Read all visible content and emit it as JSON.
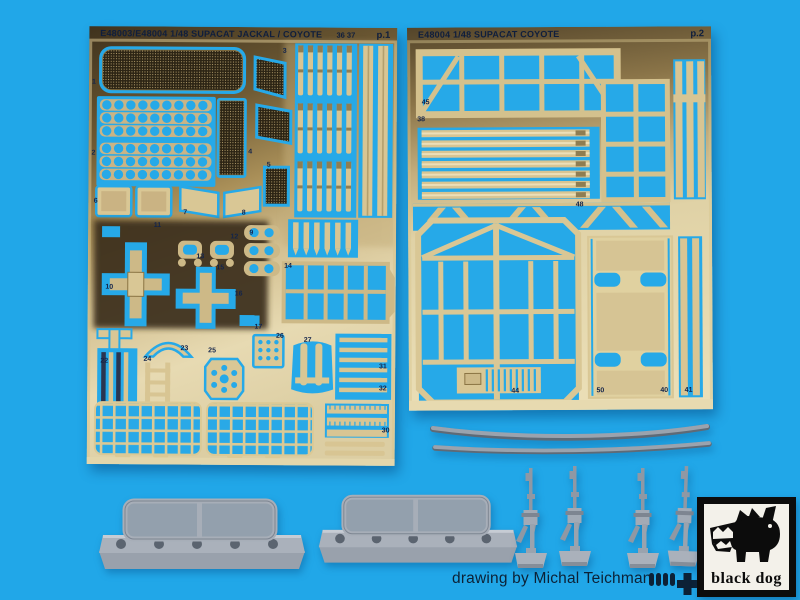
{
  "colors": {
    "background": "#21a7e8",
    "cutout_blue": "#26a9e8",
    "brass_light": "#e4d7ac",
    "brass_dark": "#453723",
    "resin_grey": "#a7aeb8",
    "text_navy": "#12203d",
    "logo_black": "#0c0c0c"
  },
  "sheets": {
    "left": {
      "title": "E48003/E48004 1/48 SUPACAT JACKAL / COYOTE",
      "header_numbers": "36 37",
      "page": "p.1",
      "part_labels": [
        {
          "t": "1",
          "x": 1.6,
          "y": 12.8
        },
        {
          "t": "2",
          "x": 1.6,
          "y": 29.0
        },
        {
          "t": "3",
          "x": 63.5,
          "y": 5.5
        },
        {
          "t": "4",
          "x": 52.5,
          "y": 28.5
        },
        {
          "t": "5",
          "x": 58.5,
          "y": 31.5
        },
        {
          "t": "6",
          "x": 2.4,
          "y": 40.0
        },
        {
          "t": "7",
          "x": 31.5,
          "y": 42.5
        },
        {
          "t": "8",
          "x": 50.5,
          "y": 42.5
        },
        {
          "t": "9",
          "x": 53.0,
          "y": 47.0
        },
        {
          "t": "11",
          "x": 22.5,
          "y": 45.5
        },
        {
          "t": "12",
          "x": 47.5,
          "y": 48.0
        },
        {
          "t": "13",
          "x": 36.5,
          "y": 52.5
        },
        {
          "t": "10",
          "x": 7.0,
          "y": 59.5
        },
        {
          "t": "15",
          "x": 43.0,
          "y": 55.0
        },
        {
          "t": "14",
          "x": 65.0,
          "y": 54.5
        },
        {
          "t": "16",
          "x": 49.0,
          "y": 61.0
        },
        {
          "t": "17",
          "x": 55.5,
          "y": 68.5
        },
        {
          "t": "22",
          "x": 5.5,
          "y": 76.5
        },
        {
          "t": "24",
          "x": 19.5,
          "y": 76.0
        },
        {
          "t": "23",
          "x": 31.5,
          "y": 73.5
        },
        {
          "t": "25",
          "x": 40.5,
          "y": 74.0
        },
        {
          "t": "26",
          "x": 62.5,
          "y": 70.5
        },
        {
          "t": "27",
          "x": 71.5,
          "y": 71.5
        },
        {
          "t": "31",
          "x": 96.0,
          "y": 77.5
        },
        {
          "t": "32",
          "x": 96.0,
          "y": 82.5
        },
        {
          "t": "30",
          "x": 97.0,
          "y": 92.0
        }
      ]
    },
    "right": {
      "title": "E48004 1/48 SUPACAT COYOTE",
      "page": "p.2",
      "part_labels": [
        {
          "t": "45",
          "x": 6.0,
          "y": 19.5
        },
        {
          "t": "38",
          "x": 4.5,
          "y": 24.0
        },
        {
          "t": "48",
          "x": 56.5,
          "y": 46.5
        },
        {
          "t": "44",
          "x": 35.0,
          "y": 95.0
        },
        {
          "t": "50",
          "x": 63.0,
          "y": 95.0
        },
        {
          "t": "40",
          "x": 84.0,
          "y": 95.0
        },
        {
          "t": "41",
          "x": 92.0,
          "y": 95.0
        }
      ]
    }
  },
  "footer": {
    "credit": "drawing by Michal Teichman",
    "publisher": "black dog"
  }
}
